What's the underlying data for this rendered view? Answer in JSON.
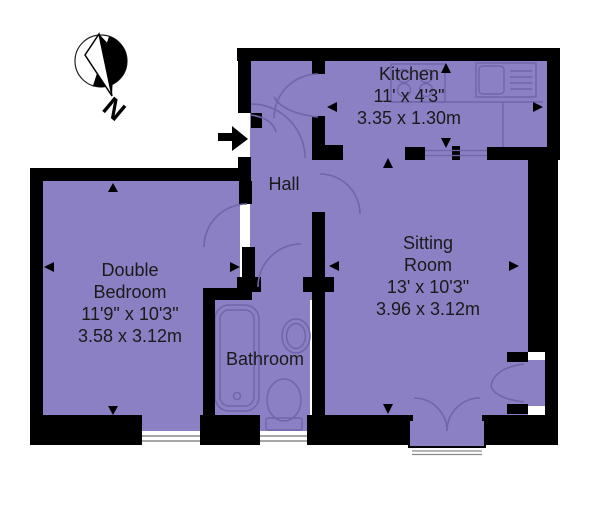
{
  "title": "Floor plan",
  "compass": {
    "label": "N"
  },
  "rooms": {
    "kitchen": {
      "name": "Kitchen",
      "imperial": "11' x 4'3\"",
      "metric": "3.35 x 1.30m"
    },
    "sitting": {
      "name_line1": "Sitting",
      "name_line2": "Room",
      "imperial": "13' x 10'3\"",
      "metric": "3.96 x 3.12m"
    },
    "bedroom": {
      "name_line1": "Double",
      "name_line2": "Bedroom",
      "imperial": "11'9\" x 10'3\"",
      "metric": "3.58 x 3.12m"
    },
    "hall": {
      "name": "Hall"
    },
    "bathroom": {
      "name": "Bathroom"
    }
  },
  "colors": {
    "floor": "#8a80c3",
    "wall": "#000000",
    "fixture": "#6f66aa",
    "window_line": "#8a8a8a",
    "text": "#1a1a1a"
  }
}
